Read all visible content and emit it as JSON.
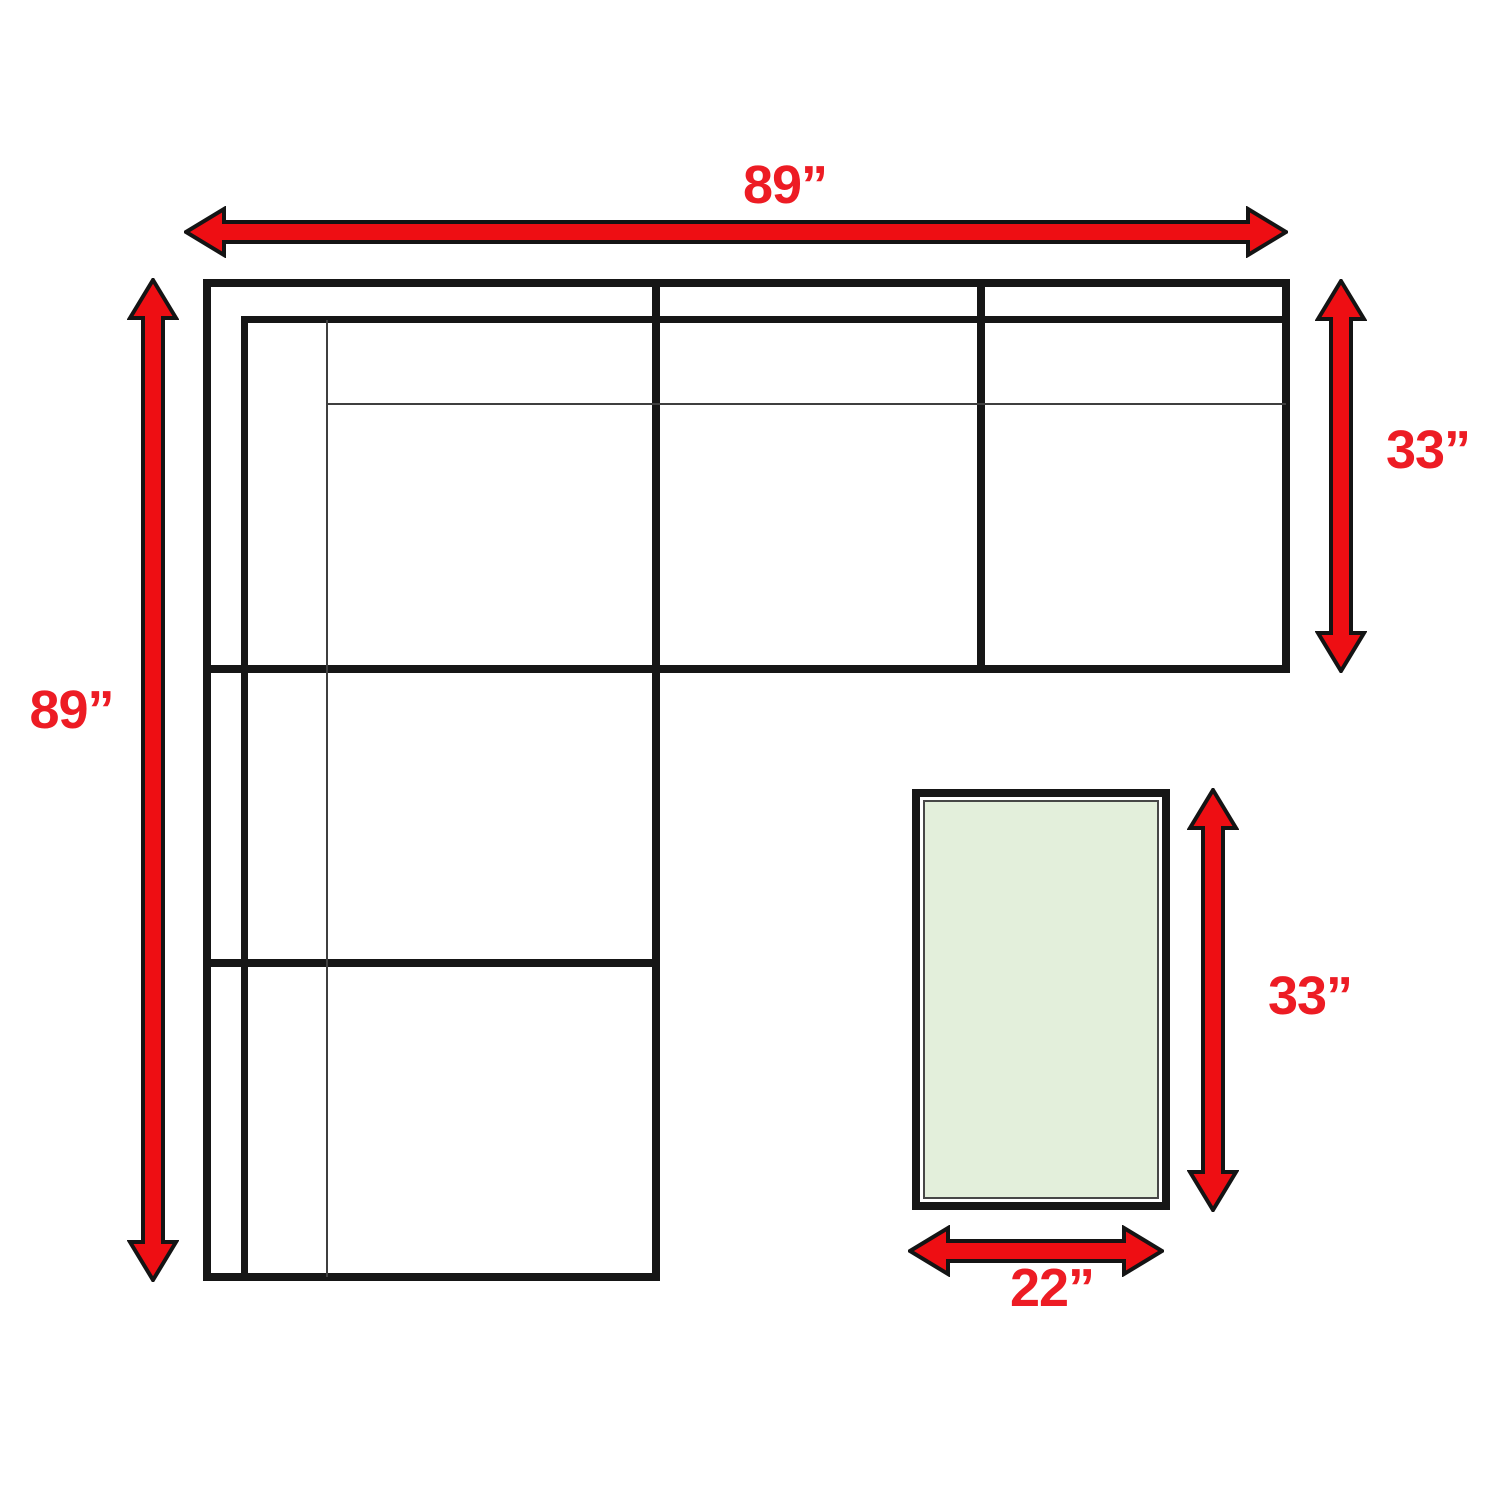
{
  "diagram": {
    "type": "sectional-sofa-dimension-diagram",
    "sofa": {
      "width_label": "89”",
      "depth_label": "89”",
      "seat_depth_label": "33”"
    },
    "ottoman": {
      "length_label": "33”",
      "width_label": "22”"
    },
    "colors": {
      "arrow_red": "#ee0e13",
      "arrow_outline": "#141414",
      "label_red": "#ed1c24",
      "line_black": "#161616",
      "line_thin": "#3f3f3f",
      "ottoman_fill": "#e3efdb",
      "ottoman_border": "#474747",
      "background": "#ffffff"
    }
  }
}
